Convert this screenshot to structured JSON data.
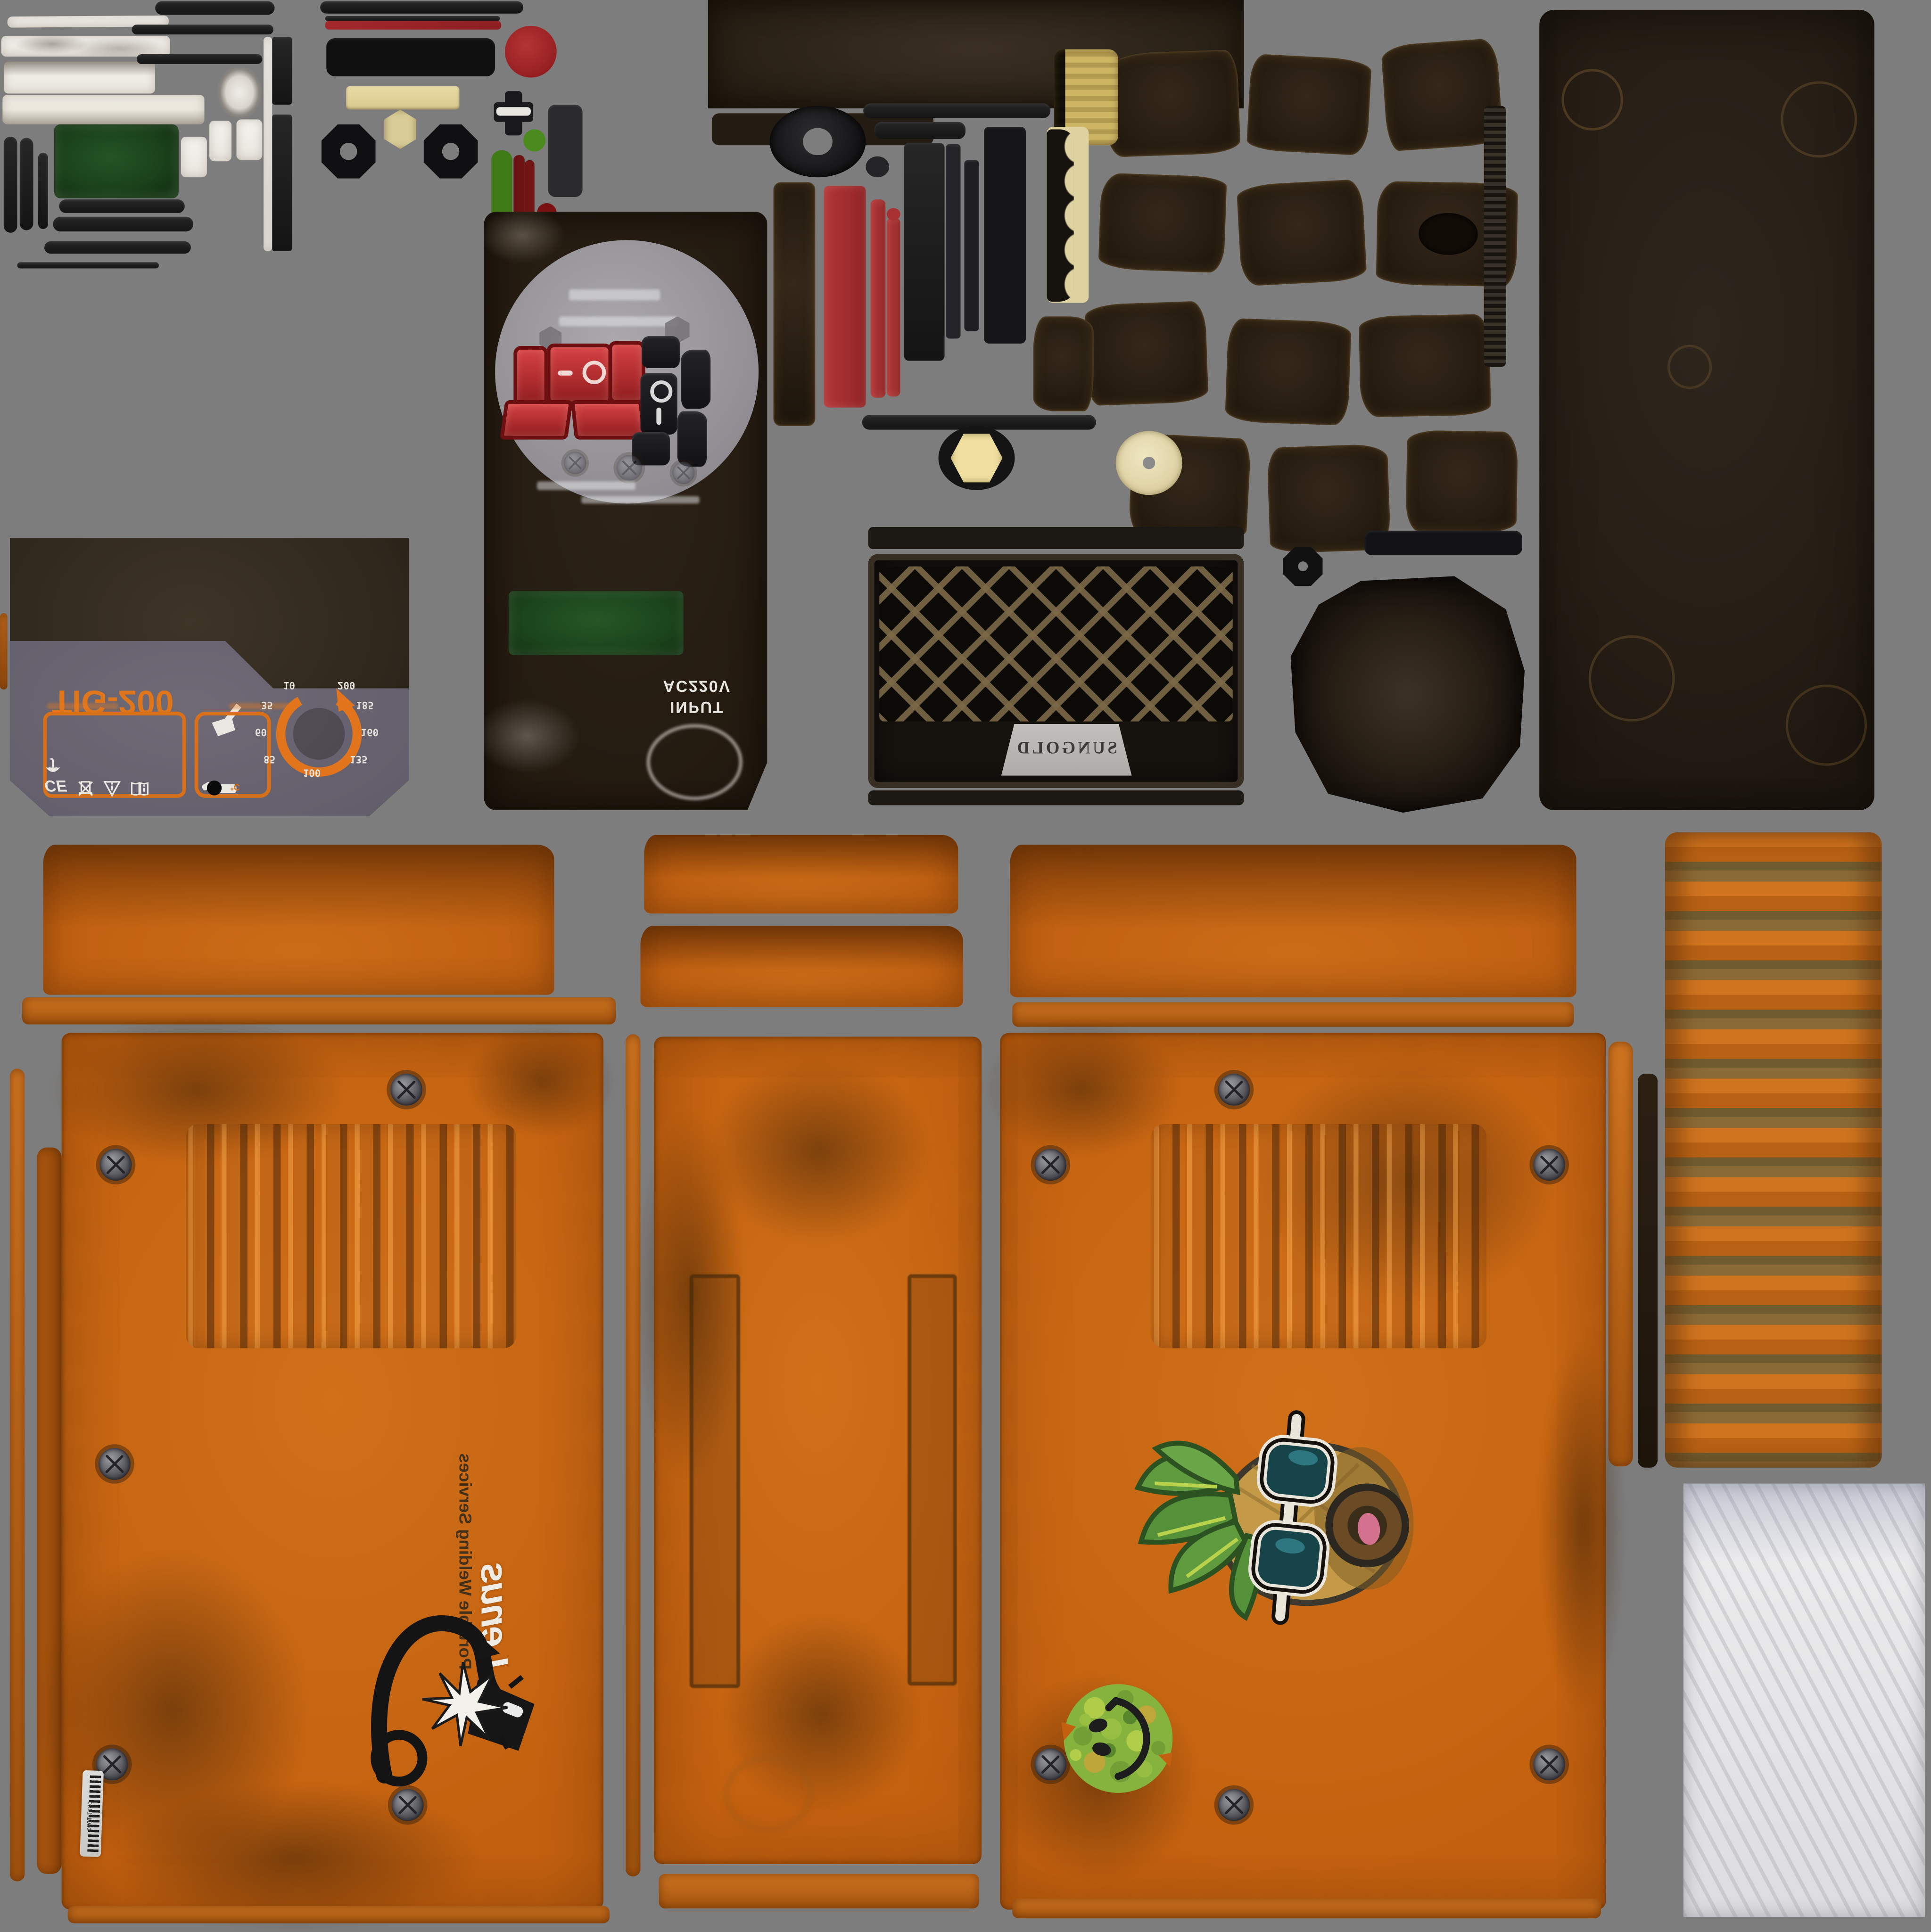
{
  "background_color": "#7d7d7d",
  "tig_panel": {
    "model_label": "TIG-200",
    "dial_labels": [
      "10",
      "35",
      "60",
      "85",
      "100",
      "135",
      "160",
      "185",
      "200"
    ],
    "temp_label": "°C",
    "ce_mark": "CE",
    "cert_icons": [
      "weee-bin-icon",
      "warning-triangle-icon",
      "manual-book-icon",
      "keep-dry-umbrella-icon"
    ],
    "accent_color": "#e0761c"
  },
  "io_panel": {
    "input_label": "INPUT",
    "voltage_label": "AC220V"
  },
  "grille": {
    "brand_label": "SUNGOLD"
  },
  "side_panel_logo": {
    "brand_label": "Lenus",
    "tagline_label": "Portable Welding Services"
  },
  "service_label": {
    "barcode_number": "0501-1490"
  },
  "stickers": {
    "pineapple": "pineapple-sunglasses-sticker",
    "smiley": "camo-smiley-sticker"
  },
  "colors": {
    "panel_orange": "#c2600f",
    "machine_gray": "#686472",
    "switch_red": "#b23133",
    "screen_green": "#1d4a1f",
    "badge_silver": "#b9b7b3",
    "rust_brown": "#5a3a16",
    "accent_orange": "#e0761c"
  }
}
